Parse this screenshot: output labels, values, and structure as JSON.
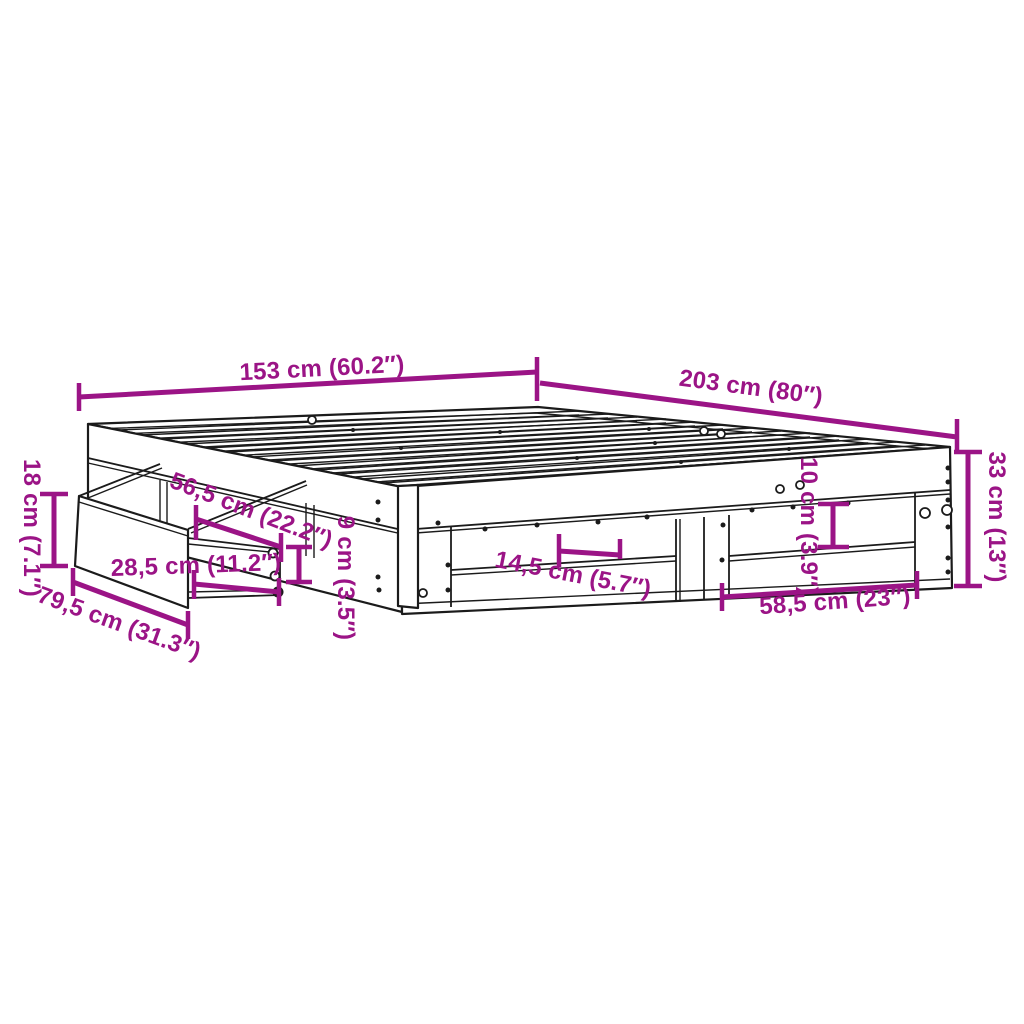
{
  "colors": {
    "accent": "#9B1486",
    "line_art": "#1B1B1B",
    "background": "#FFFFFF"
  },
  "diagram": {
    "type": "product-dimension-diagram",
    "subject": "bed frame with slats, side shelves and pull-out drawer",
    "dimensions": [
      {
        "id": "width",
        "label": "153 cm (60.2″)",
        "cm": "153",
        "inch": "60.2"
      },
      {
        "id": "length",
        "label": "203 cm (80″)",
        "cm": "203",
        "inch": "80"
      },
      {
        "id": "height",
        "label": "33 cm (13″)",
        "cm": "33",
        "inch": "13"
      },
      {
        "id": "drawer-front-height",
        "label": "18 cm (7.1″)",
        "cm": "18",
        "inch": "7.1"
      },
      {
        "id": "drawer-extension",
        "label": "56,5 cm (22.2″)",
        "cm": "56,5",
        "inch": "22.2"
      },
      {
        "id": "drawer-inner-depth",
        "label": "28,5 cm (11.2″)",
        "cm": "28,5",
        "inch": "11.2"
      },
      {
        "id": "drawer-width",
        "label": "79,5 cm (31.3″)",
        "cm": "79,5",
        "inch": "31.3"
      },
      {
        "id": "rail-height",
        "label": "9 cm (3.5″)",
        "cm": "9",
        "inch": "3.5"
      },
      {
        "id": "shelf-depth",
        "label": "14,5 cm (5.7″)",
        "cm": "14,5",
        "inch": "5.7"
      },
      {
        "id": "shelf-gap-height",
        "label": "10 cm (3.9″)",
        "cm": "10",
        "inch": "3.9"
      },
      {
        "id": "opening-width",
        "label": "58,5 cm (23″)",
        "cm": "58,5",
        "inch": "23"
      }
    ]
  }
}
